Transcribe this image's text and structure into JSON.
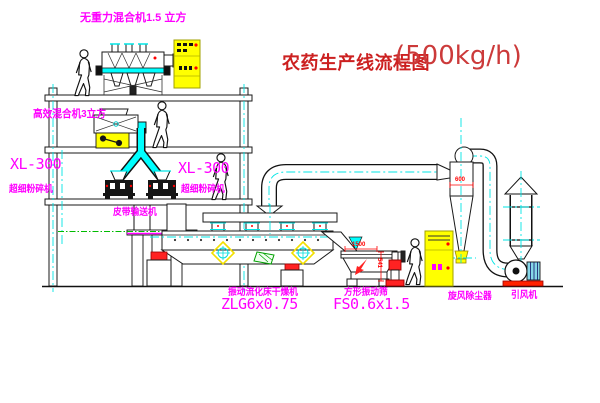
{
  "title": {
    "main": "农药生产线流程图",
    "capacity": "(500kg/h)"
  },
  "labels": {
    "top_mixer": "无重力混合机1.5 立方",
    "mid_mixer": "高效混合机3立方",
    "mill_left_model": "XL-300",
    "mill_left_name": "超细粉碎机",
    "mill_right_model": "XL-300",
    "mill_right_name": "超细粉碎机",
    "belt_conveyor": "皮带输送机",
    "dryer_name": "振动流化床干燥机",
    "dryer_model": "ZLG6x0.75",
    "screen_name": "方形振动筛",
    "screen_model": "FS0.6x1.5",
    "cyclone_name": "旋风除尘器",
    "fan_name": "引风机"
  },
  "dimensions": {
    "cyclone_width": "600",
    "screen_length": "1500",
    "screen_height": "541"
  },
  "colors": {
    "label_magenta": "#ff00ff",
    "title_red": "#cc2020",
    "line_black": "#1a1a1a",
    "equipment_yellow": "#ffff00",
    "pipe_cyan": "#00e5e5",
    "centerline_green": "#00bb00",
    "dimension_red": "#ff0000"
  }
}
